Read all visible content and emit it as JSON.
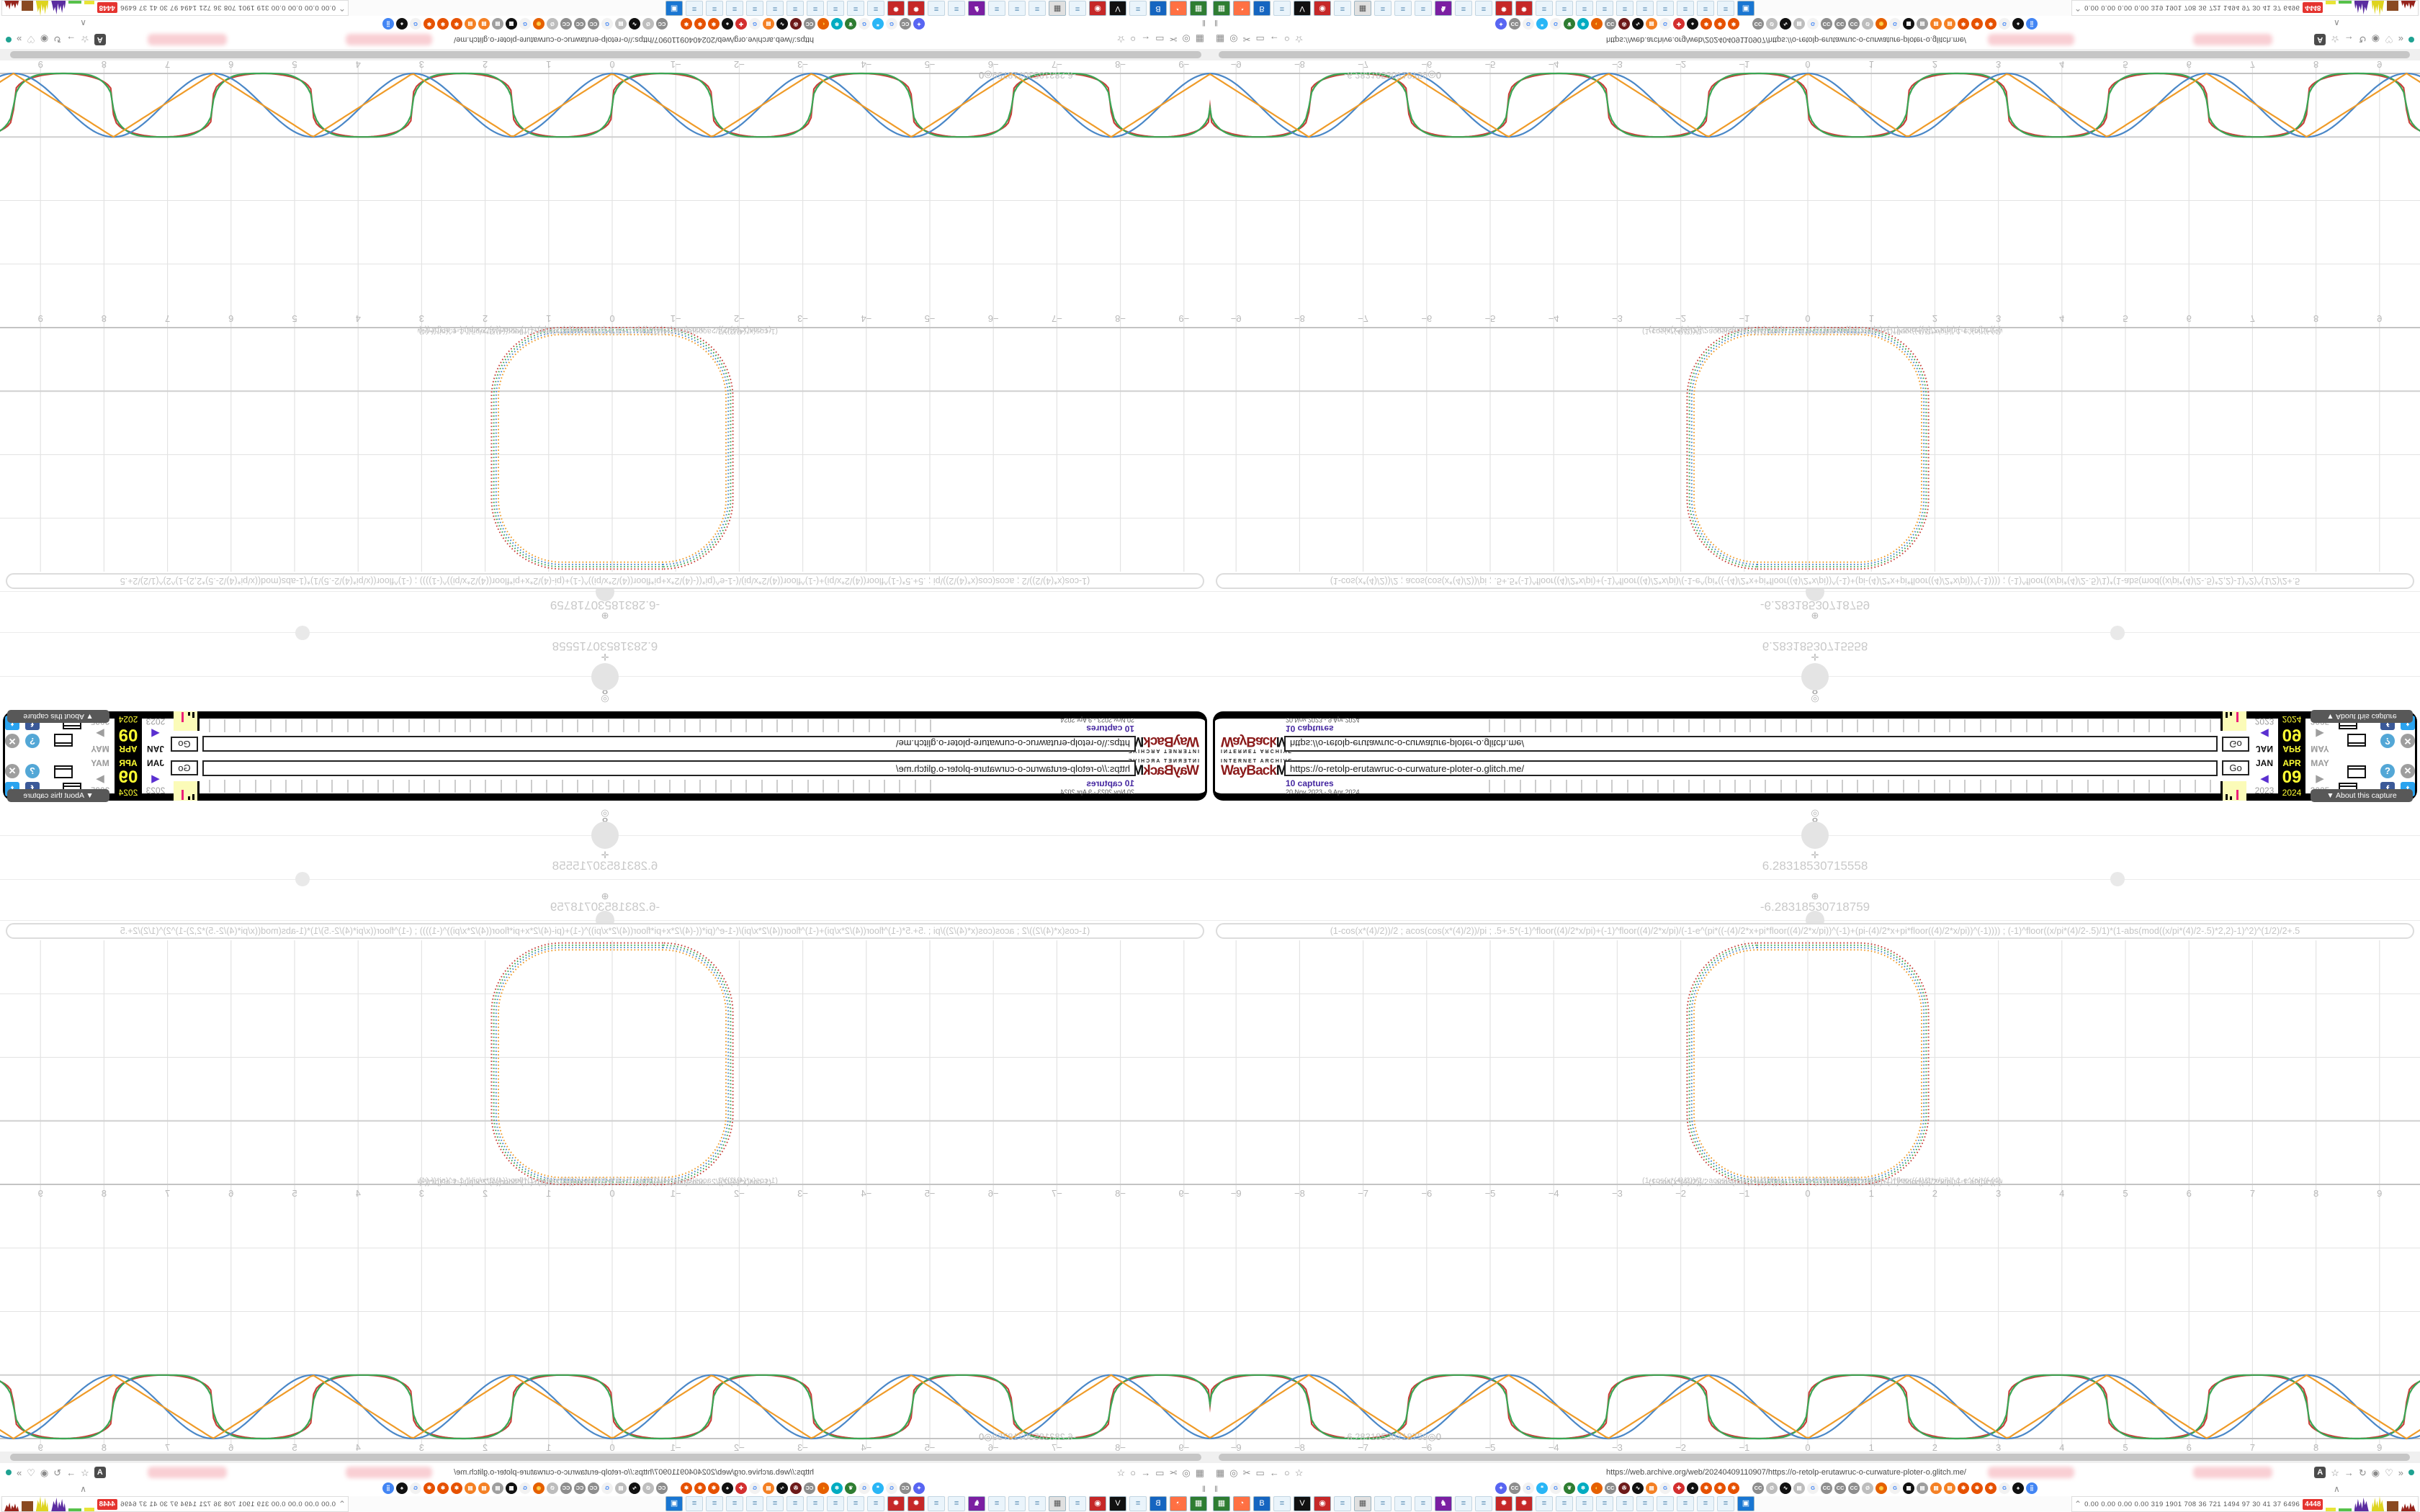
{
  "wayback": {
    "logo_sub": "INTERNET ARCHIVE",
    "logo_way": "WayBack",
    "logo_machine": "Machine",
    "url_value": "https://o-retolp-erutawruc-o-curwature-ploter-o.glitch.me/",
    "captures_label": "10 captures",
    "date_range": "20 Nov 2023 - 9 Apr 2024",
    "go_label": "Go",
    "months": [
      "JAN",
      "APR",
      "MAY"
    ],
    "day": "09",
    "years": [
      "2023",
      "2024",
      "2025"
    ],
    "prev_arrow": "◀",
    "next_arrow": "▶",
    "about_icon": "▼",
    "about_label": "About this capture",
    "help_icon": "?",
    "close_icon": "✕",
    "facebook_icon": "f",
    "twitter_icon": "t",
    "timeline_ticks": 48
  },
  "plotter": {
    "anchor_icon": "◎",
    "param_value": "8",
    "move_icon": "✛",
    "value_pos": "6.28318530715558",
    "resize_icon": "⊕",
    "value_neg": "-6.28318530718759",
    "marker_value": "-6.28318530718759",
    "marker_suffix": "◎0",
    "formula": "(1-cos(x*(4)/2))/2 ; acos(cos(x*(4)/2))/pi ; .5+.5*(-1)^floor((4)/2*x/pi)+(-1)^floor((4)/2*x/pi)/(-1-e^(pi*((-(4)/2*x+pi*floor((4)/2*x/pi))^(-1)+(pi-(4)/2*x+pi*floor((4)/2*x/pi))^(-1)))) ; (-1)^floor((x/pi*(4)/2-.5)/1)*(1-abs(mod((x/pi*(4)/2-.5)*2,2)-1)^2)^(1/2)/2+.5"
  },
  "chart_data": {
    "panels": [
      {
        "type": "line",
        "title": "parametric rounded-square plot",
        "x_ticks": [
          -9,
          -8,
          -7,
          -6,
          -5,
          -4,
          -3,
          -2,
          -1,
          0,
          1,
          2,
          3,
          4,
          5,
          6,
          7,
          8,
          9
        ],
        "grid": true,
        "square": {
          "x_min": -1.9,
          "x_max": 1.9,
          "y_min": 0,
          "y_max": 3.8,
          "corner_radius": 1.1,
          "stroke_style": "dotted",
          "colors": [
            "#c8403a",
            "#3aa655",
            "#4a87c7",
            "#ef9b28"
          ]
        }
      },
      {
        "type": "line",
        "title": "component waveforms, period pi, amplitude 0..1",
        "x_ticks": [
          -9,
          -8,
          -7,
          -6,
          -5,
          -4,
          -3,
          -2,
          -1,
          0,
          1,
          2,
          3,
          4,
          5,
          6,
          7,
          8,
          9
        ],
        "x_range": [
          -9.7,
          9.7
        ],
        "ylim": [
          0,
          1
        ],
        "grid": true,
        "series": [
          {
            "name": "(1-cos(x*(4)/2))/2",
            "shape": "sin2",
            "color": "#4a87c7"
          },
          {
            "name": "acos(cos(x*(4)/2))/pi",
            "shape": "triangle",
            "color": "#ef9b28"
          },
          {
            "name": ".5+.5*(-1)^floor((4)/2*x/pi)+...",
            "shape": "smoothsquare",
            "color": "#c8403a"
          },
          {
            "name": "(-1)^floor((x/pi*(4)/2-.5)/1)*(1-abs(mod(...,2)-1)^2)^(1/2)/2+.5",
            "shape": "circlescallop",
            "color": "#3aa655"
          }
        ],
        "zeros_at": "multiples of pi (…, -6.283, -3.142, 0, 3.142, 6.283, …)",
        "peaks_at": "pi/2 + k*pi, value 1"
      }
    ]
  },
  "browser": {
    "url": "https://web.archive.org/web/20240409110907/https://o-retolp-erutawruc-o-curwature-ploter-o.glitch.me/",
    "left_icons": [
      "▦",
      "◎",
      "✂",
      "▭",
      "←",
      "○",
      "☆"
    ],
    "translate_icon": "A",
    "right_icons": [
      "☆",
      "→",
      "↻",
      "◉",
      "♡",
      "»"
    ],
    "pause_icon": "‖",
    "collapse_icon": "∧",
    "bookmarks": [
      {
        "bg": "#5865f2",
        "fg": "#ffffff",
        "g": "✦"
      },
      {
        "bg": "#8d8d8d",
        "fg": "#ffffff",
        "g": "CC"
      },
      {
        "bg": "#f2f2f2",
        "fg": "#4285f4",
        "g": "G"
      },
      {
        "bg": "#29b6f6",
        "fg": "#ffffff",
        "g": "❝"
      },
      {
        "bg": "#f2f2f2",
        "fg": "#4285f4",
        "g": "G"
      },
      {
        "bg": "#2e7d32",
        "fg": "#ffffff",
        "g": "❦"
      },
      {
        "bg": "#00acc1",
        "fg": "#ffffff",
        "g": "❄"
      },
      {
        "bg": "#e66000",
        "fg": "#ffd54f",
        "g": "◐"
      },
      {
        "bg": "#8d8d8d",
        "fg": "#ffffff",
        "g": "CC"
      },
      {
        "bg": "#6d1a1a",
        "fg": "#ffffff",
        "g": "✇"
      },
      {
        "bg": "#111111",
        "fg": "#ffffff",
        "g": "∿"
      },
      {
        "bg": "#f48024",
        "fg": "#ffffff",
        "g": "▤"
      },
      {
        "bg": "#f2f2f2",
        "fg": "#4285f4",
        "g": "G"
      },
      {
        "bg": "#d32f2f",
        "fg": "#ffffff",
        "g": "✚"
      },
      {
        "bg": "#111111",
        "fg": "#ffffff",
        "g": "♠"
      },
      {
        "bg": "#e65100",
        "fg": "#ffffff",
        "g": "✱"
      },
      {
        "bg": "#e65100",
        "fg": "#ffffff",
        "g": "✱"
      },
      {
        "bg": "#e65100",
        "fg": "#ffffff",
        "g": "✱"
      },
      {
        "sp": true
      },
      {
        "bg": "#8d8d8d",
        "fg": "#ffffff",
        "g": "CC"
      },
      {
        "bg": "#bdbdbd",
        "fg": "#ffffff",
        "g": "Ø"
      },
      {
        "bg": "#111111",
        "fg": "#ffffff",
        "g": "∿"
      },
      {
        "bg": "#bdbdbd",
        "fg": "#ffffff",
        "g": "▤"
      },
      {
        "bg": "#f2f2f2",
        "fg": "#4285f4",
        "g": "G"
      },
      {
        "bg": "#8d8d8d",
        "fg": "#ffffff",
        "g": "CC"
      },
      {
        "bg": "#8d8d8d",
        "fg": "#ffffff",
        "g": "CC"
      },
      {
        "bg": "#8d8d8d",
        "fg": "#ffffff",
        "g": "CC"
      },
      {
        "bg": "#bdbdbd",
        "fg": "#ffffff",
        "g": "Ø"
      },
      {
        "bg": "#e66000",
        "fg": "#ffd54f",
        "g": "◉"
      },
      {
        "bg": "#f2f2f2",
        "fg": "#4285f4",
        "g": "G"
      },
      {
        "bg": "#111111",
        "fg": "#ffffff",
        "g": "▦"
      },
      {
        "bg": "#9e9e9e",
        "fg": "#ffffff",
        "g": "▤"
      },
      {
        "bg": "#f48024",
        "fg": "#ffffff",
        "g": "▤"
      },
      {
        "bg": "#f48024",
        "fg": "#ffffff",
        "g": "▤"
      },
      {
        "bg": "#e65100",
        "fg": "#ffffff",
        "g": "✱"
      },
      {
        "bg": "#e65100",
        "fg": "#ffffff",
        "g": "✱"
      },
      {
        "bg": "#e65100",
        "fg": "#ffffff",
        "g": "✱"
      },
      {
        "bg": "#f2f2f2",
        "fg": "#4285f4",
        "g": "G"
      },
      {
        "bg": "#111111",
        "fg": "#ffffff",
        "g": "♠"
      },
      {
        "bg": "#4285f4",
        "fg": "#ffffff",
        "g": "⣿"
      }
    ],
    "taskbar": [
      {
        "bg": "#2e7d32",
        "fg": "#ffffff",
        "g": "▦"
      },
      {
        "bg": "#ff7043",
        "fg": "#ffffff",
        "g": "◔"
      },
      {
        "bg": "#1565c0",
        "fg": "#ffffff",
        "g": "B"
      },
      {
        "note": true
      },
      {
        "bg": "#111111",
        "fg": "#ffffff",
        "g": "V"
      },
      {
        "bg": "#c62828",
        "fg": "#ffffff",
        "g": "◉"
      },
      {
        "note": true
      },
      {
        "bg": "#e0e0e0",
        "fg": "#555555",
        "g": "▦"
      },
      {
        "note": true
      },
      {
        "note": true
      },
      {
        "note": true
      },
      {
        "bg": "#7b1fa2",
        "fg": "#ffffff",
        "g": "♞"
      },
      {
        "note": true
      },
      {
        "note": true
      },
      {
        "bg": "#c62828",
        "fg": "#ffffff",
        "g": "✹"
      },
      {
        "bg": "#c62828",
        "fg": "#ffffff",
        "g": "✹"
      },
      {
        "note": true
      },
      {
        "note": true
      },
      {
        "note": true
      },
      {
        "note": true
      },
      {
        "note": true
      },
      {
        "note": true
      },
      {
        "note": true
      },
      {
        "note": true
      },
      {
        "note": true
      },
      {
        "note": true
      },
      {
        "bg": "#1976d2",
        "fg": "#ffffff",
        "g": "▣"
      }
    ]
  },
  "stats": {
    "expand_icon": "⌃",
    "values": "0.00 0.00 0.00 0.00  319 1901 708   36   721 1494  97   30   41   37  6496",
    "badge": "4448",
    "segments": [
      {
        "c": "#e8e437",
        "w": 30,
        "h": 5,
        "spiky": false
      },
      {
        "c": "#56c14a",
        "w": 38,
        "h": 4,
        "spiky": false
      },
      {
        "c": "#5b2da0",
        "w": 44,
        "h": 19,
        "spiky": true
      },
      {
        "c": "#ded41f",
        "w": 38,
        "h": 21,
        "spiky": true
      },
      {
        "c": "#8a4a21",
        "w": 34,
        "h": 14,
        "spiky": false
      },
      {
        "c": "#96231b",
        "w": 44,
        "h": 12,
        "spiky": true
      }
    ]
  }
}
